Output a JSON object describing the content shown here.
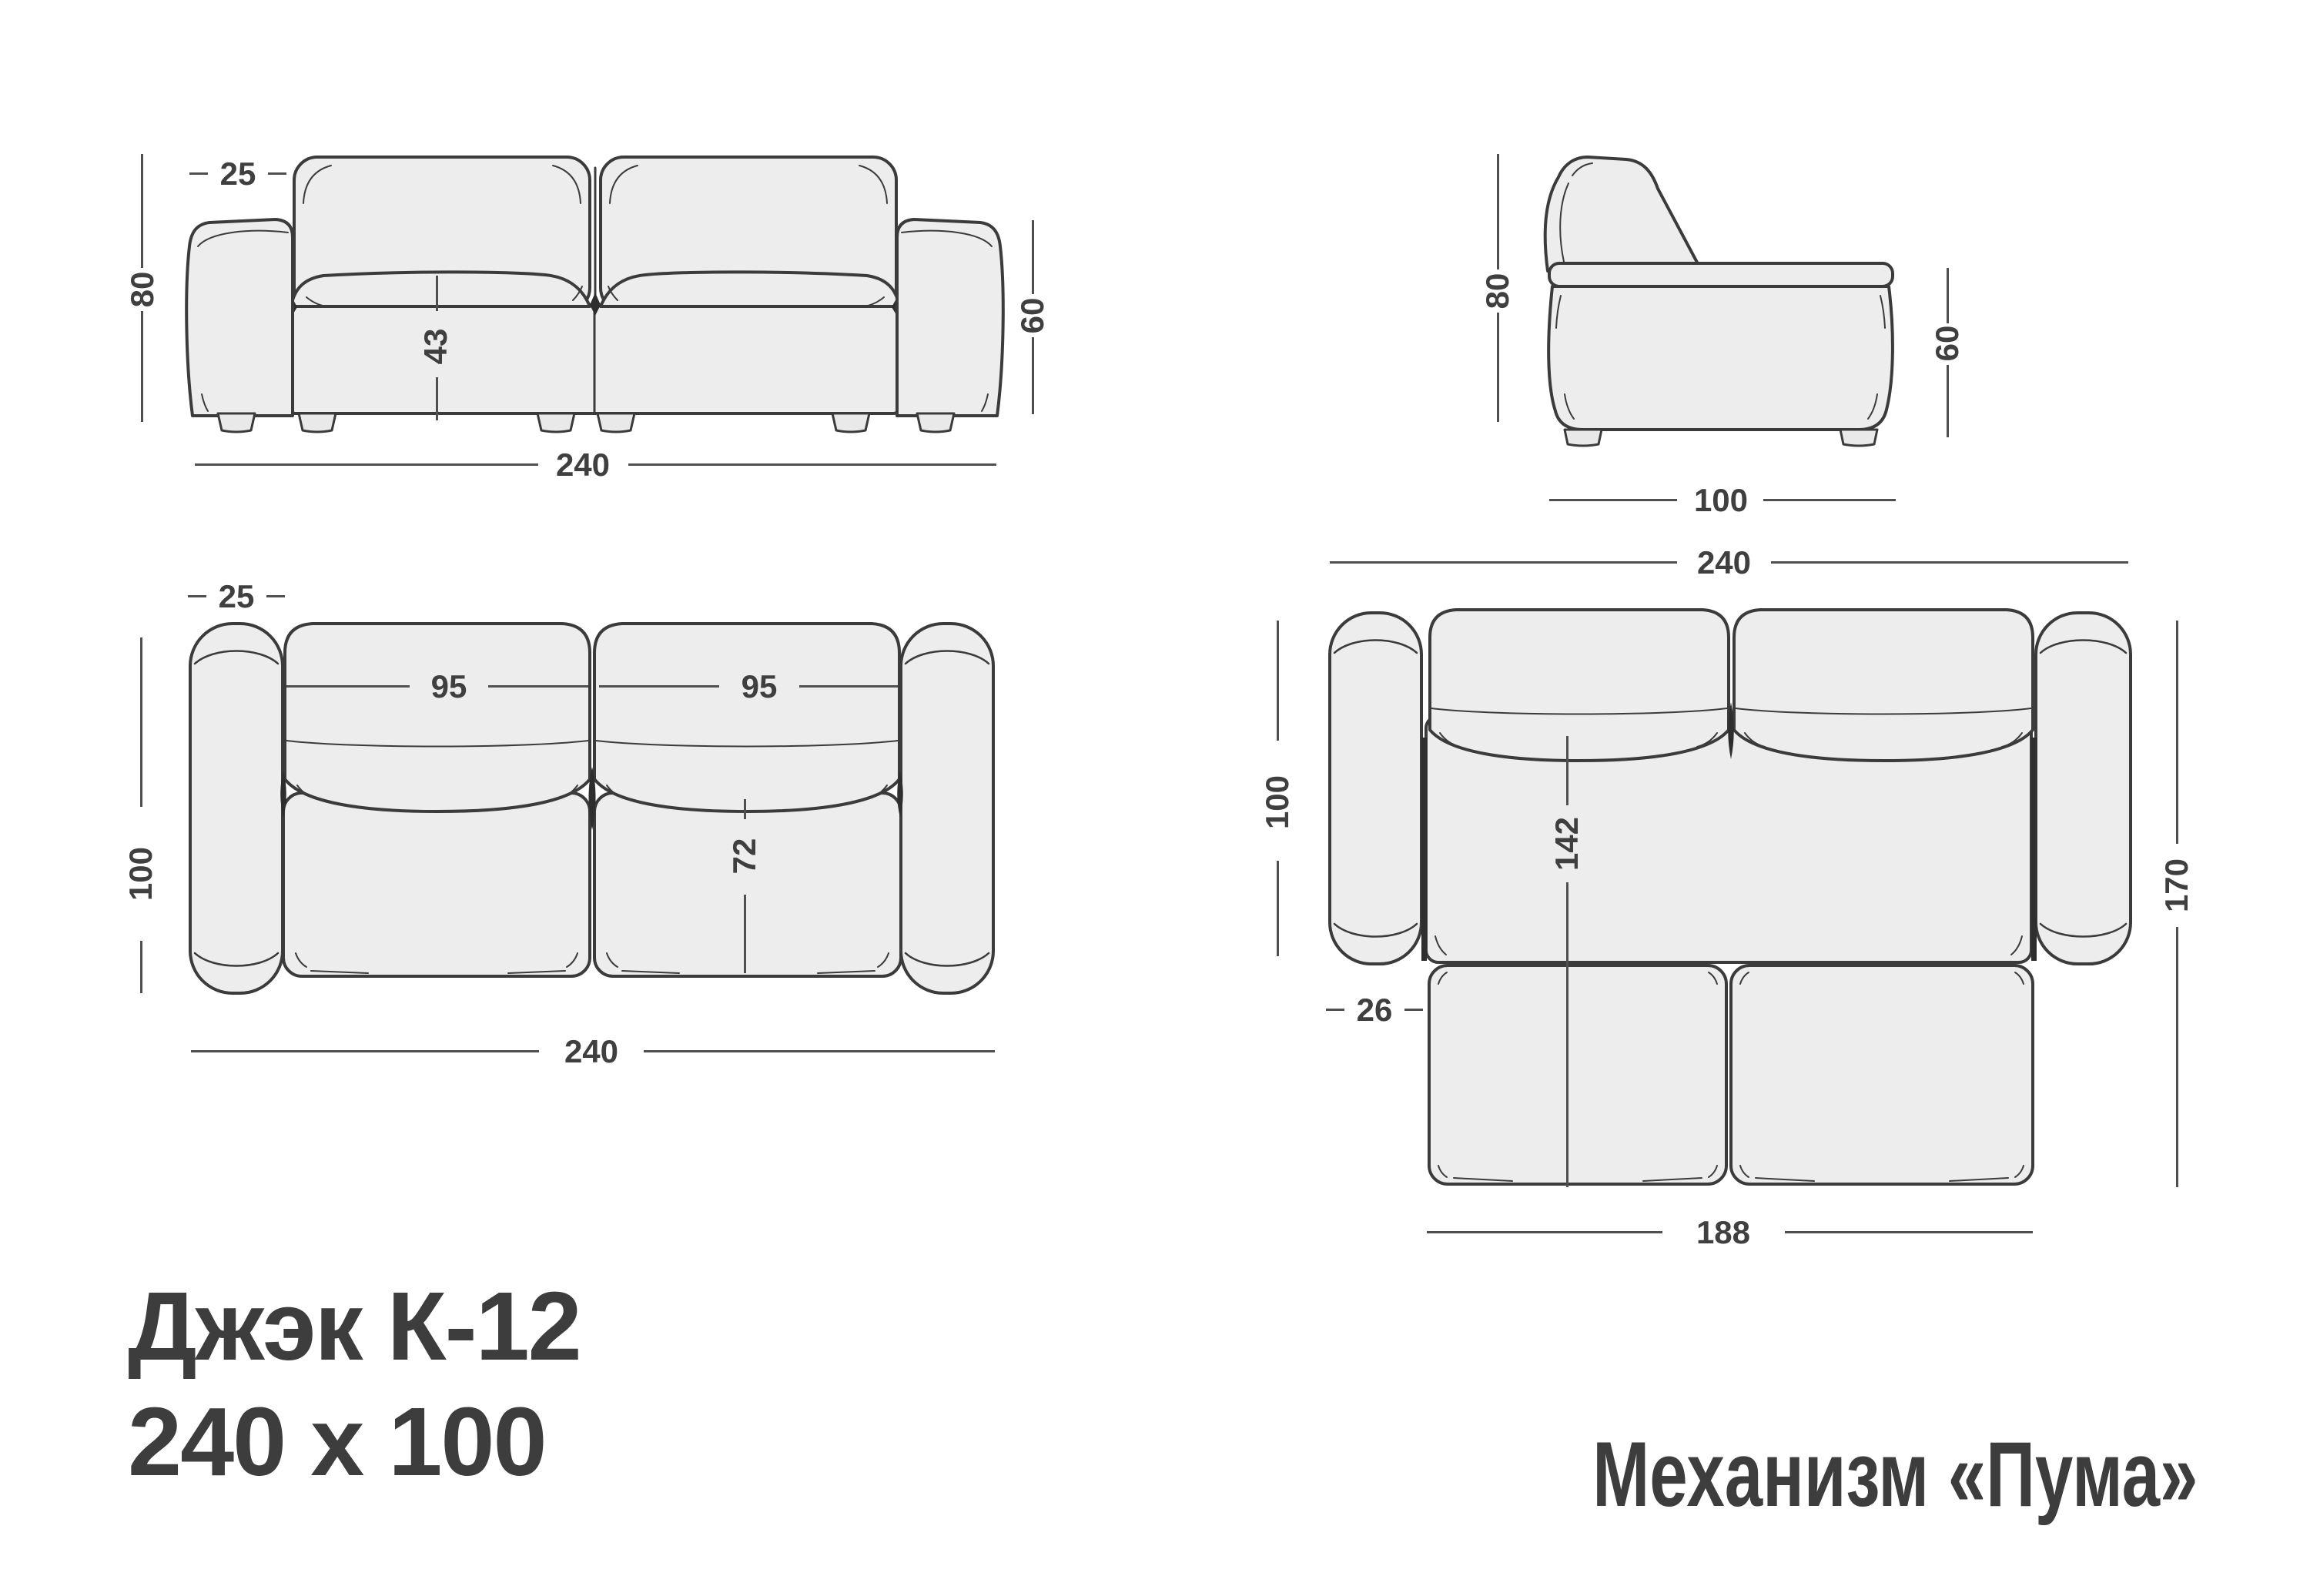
{
  "title": {
    "line1": "Джэк К-12",
    "line2": "240 x 100"
  },
  "mechanism_label": "Механизм «Пума»",
  "colors": {
    "background": "#ffffff",
    "outline": "#3b3b3b",
    "fill_light": "#ededed",
    "shadow_dark": "#2e2e2e",
    "dimension_line": "#4f4f4f",
    "text": "#3d3d3d"
  },
  "views": {
    "front": {
      "name": "front-view",
      "dims": {
        "backrest_thickness": "25",
        "total_height": "80",
        "seat_height": "43",
        "armrest_height": "60",
        "total_width": "240"
      }
    },
    "side": {
      "name": "side-view",
      "dims": {
        "total_height": "80",
        "armrest_height": "60",
        "total_depth": "100"
      }
    },
    "top_folded": {
      "name": "top-view-folded",
      "dims": {
        "backrest_thickness": "25",
        "total_depth": "100",
        "seat_width_left": "95",
        "seat_width_right": "95",
        "seat_depth": "72",
        "total_width": "240"
      }
    },
    "top_unfolded": {
      "name": "top-view-unfolded",
      "dims": {
        "total_width": "240",
        "sofa_depth": "100",
        "bed_length": "142",
        "unfolded_depth": "170",
        "side_offset": "26",
        "bed_width": "188"
      }
    }
  }
}
